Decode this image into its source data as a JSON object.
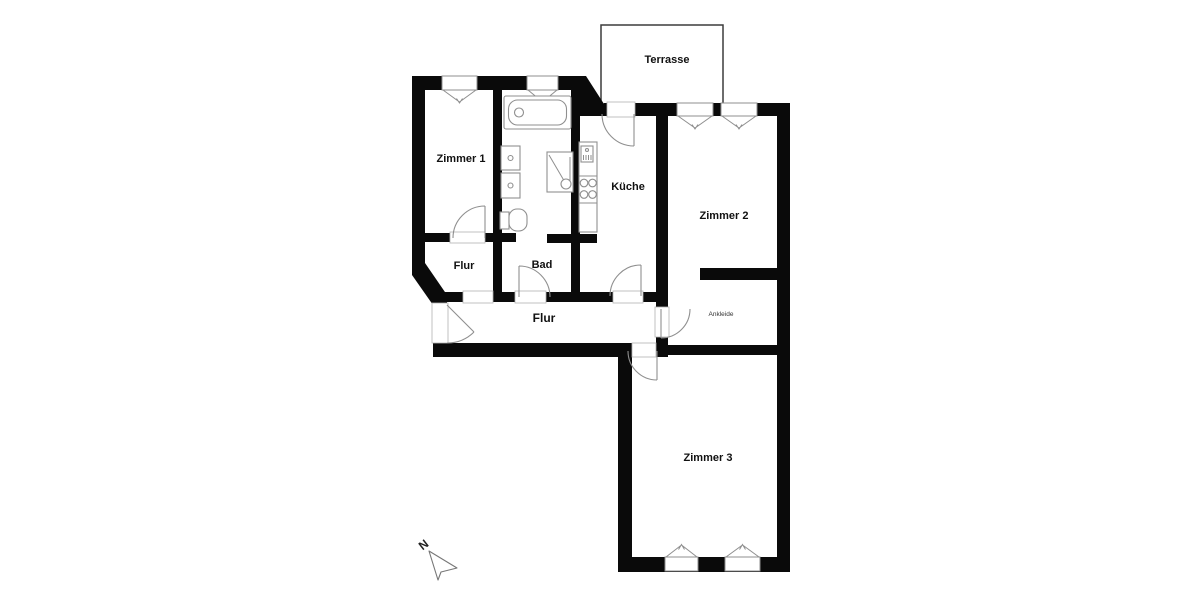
{
  "plan": {
    "rooms": {
      "zimmer1": "Zimmer 1",
      "zimmer2": "Zimmer 2",
      "zimmer3": "Zimmer 3",
      "kueche": "Küche",
      "bad": "Bad",
      "flur_klein": "Flur",
      "flur": "Flur",
      "ankleide": "Ankleide",
      "terrasse": "Terrasse"
    },
    "compass": {
      "north": "N"
    },
    "icons": {
      "north-arrow-icon": "outlined dart arrow pointing upper-left",
      "bathtub-icon": "rectangle with rounded inner tub and drain circle",
      "shower-icon": "square with diagonal line to drain circle",
      "toilet-icon": "tank rectangle with rounded bowl",
      "washing-machine-icon": "square with center dot (two stacked)",
      "stove-icon": "four burner circles on counter strip",
      "kitchen-appliance-icon": "small hatched appliance box",
      "window-icon": "white wall gap with inward triangle casement marks",
      "door-swing-icon": "quarter-circle arc with door leaf line"
    },
    "colors": {
      "wall": "#0a0a0a",
      "fixture_line": "#8f8f8f",
      "door_line": "#8f8f8f",
      "opening_line": "#b3b3b3",
      "terrace_outline": "#3c3c3c",
      "label_text": "#111111",
      "background": "#ffffff"
    }
  }
}
